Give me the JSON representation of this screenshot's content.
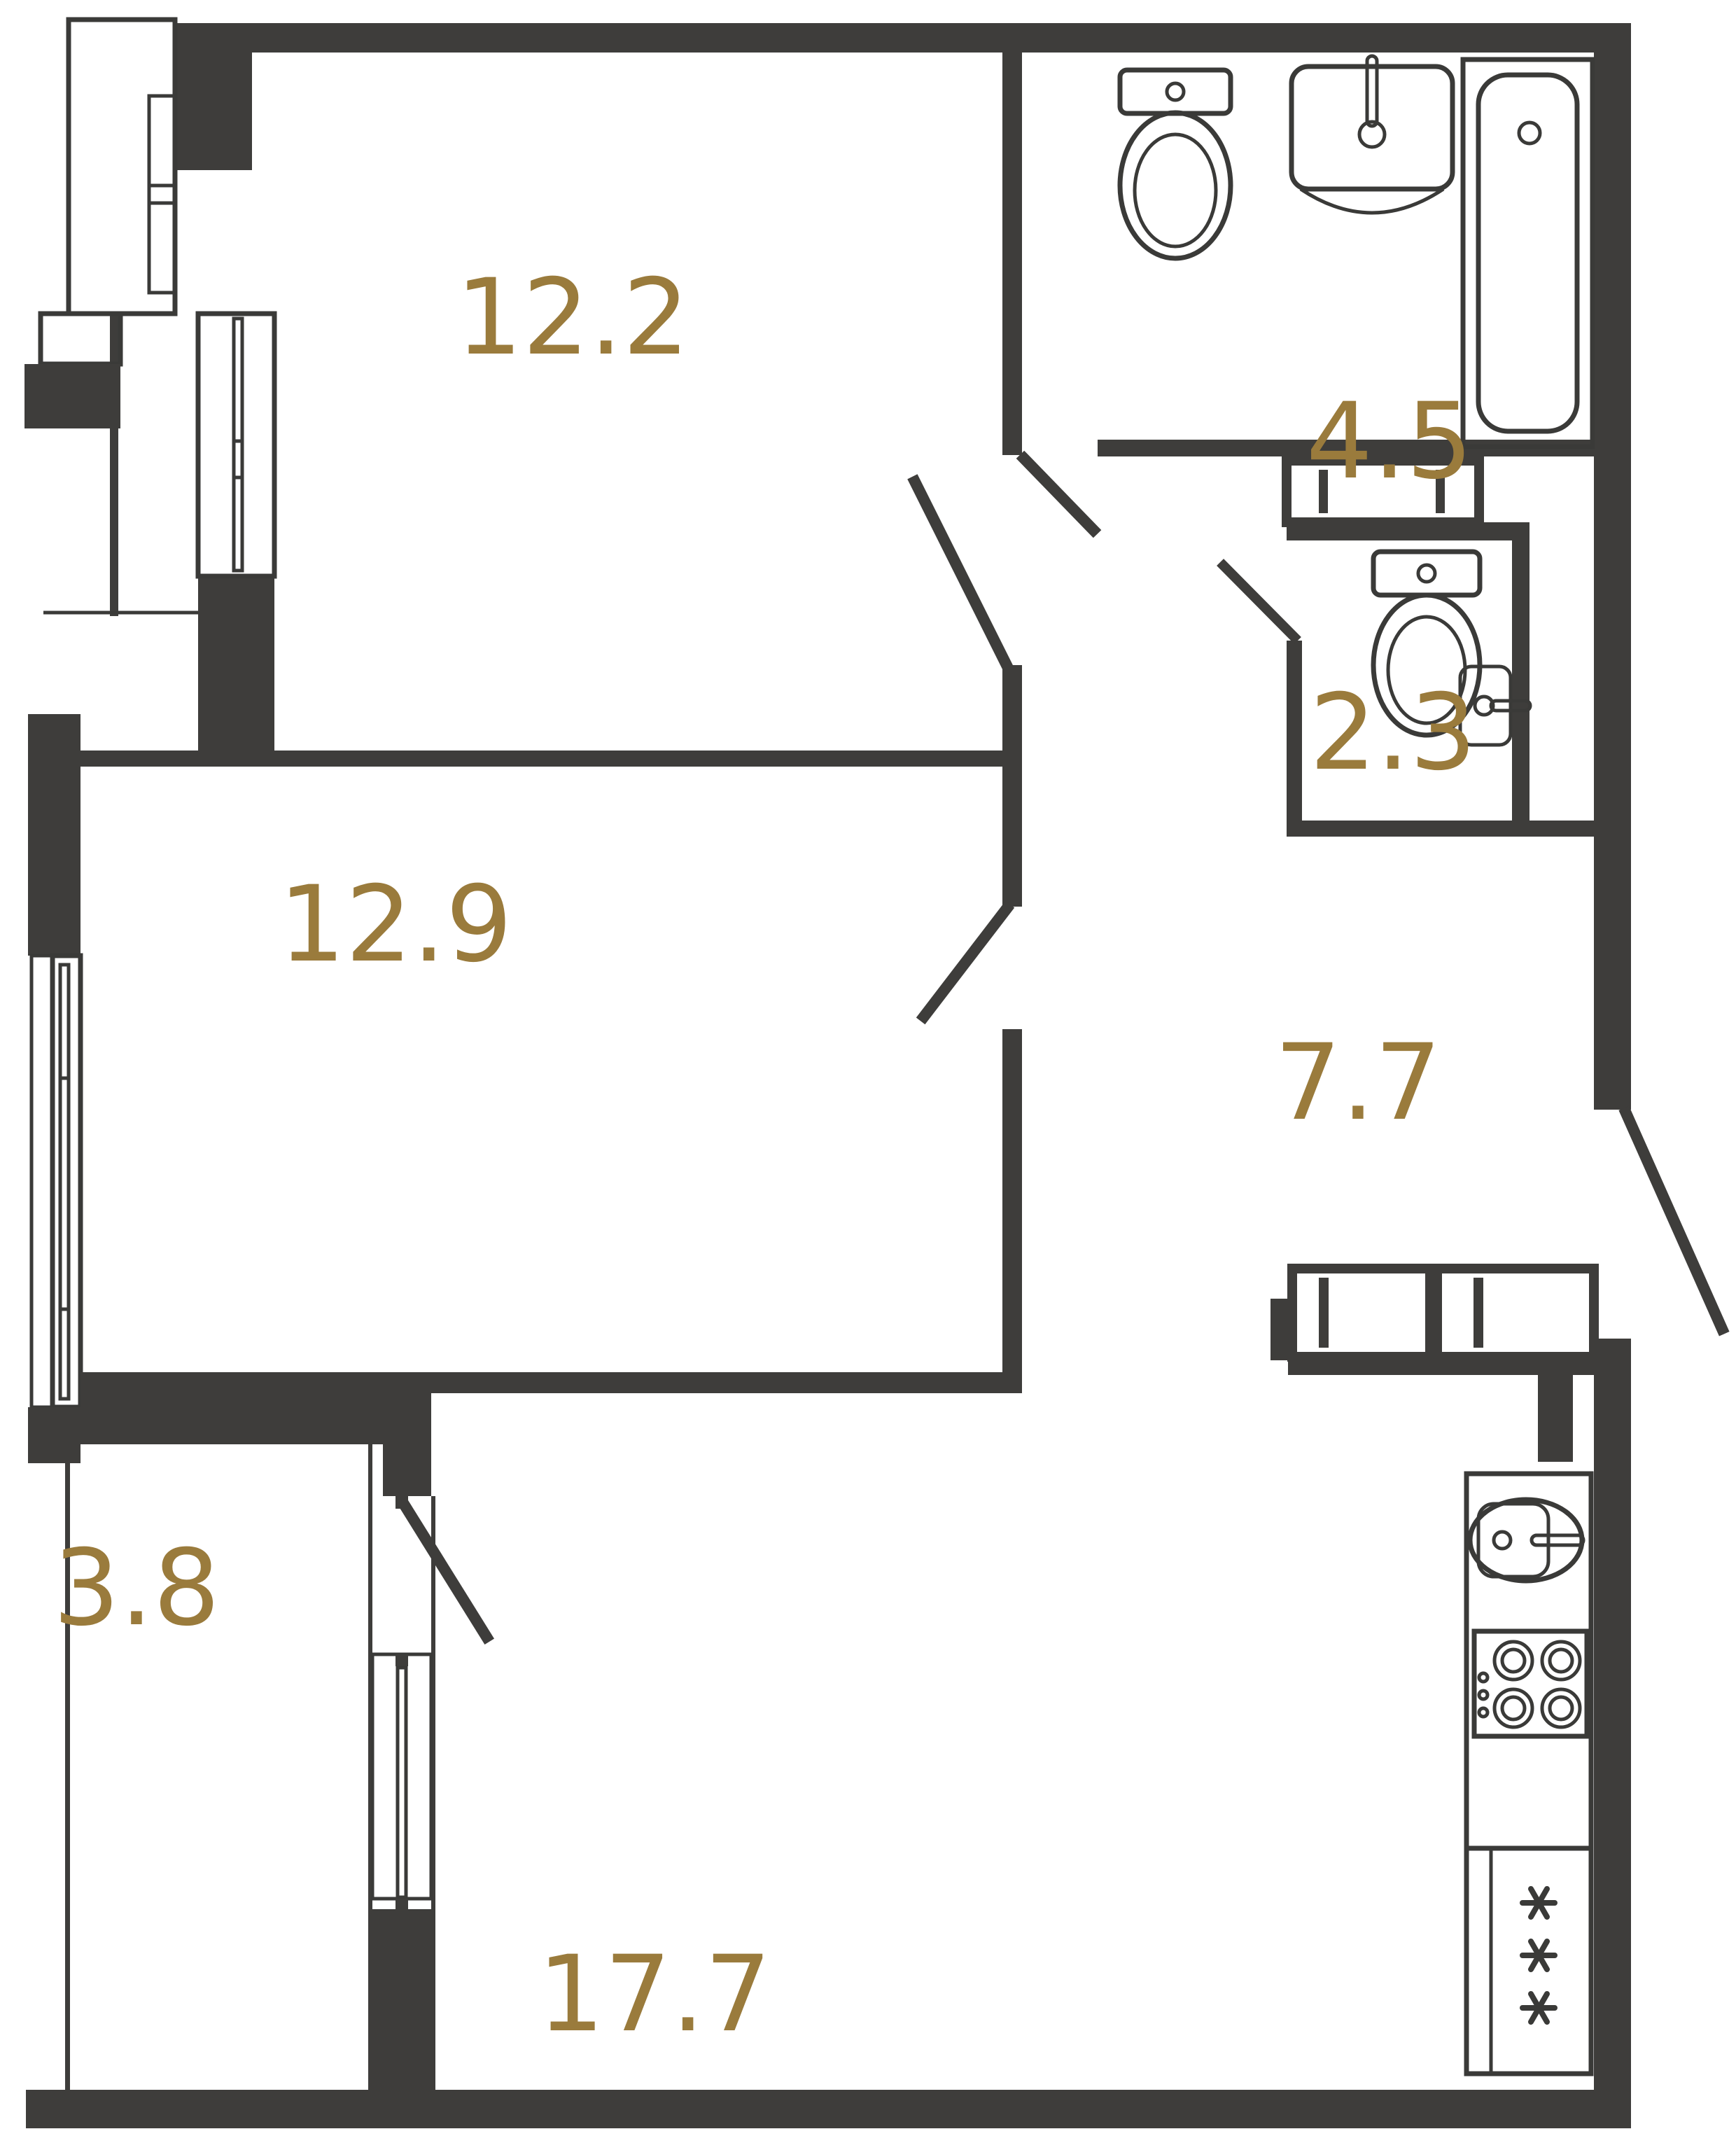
{
  "document_type": "apartment floor plan",
  "colors": {
    "wall": "#3E3D3B",
    "fixture_line": "#3A3A38",
    "label": "#9A7B3C",
    "background": "#FFFFFF"
  },
  "rooms": [
    {
      "id": "room-12-2",
      "area": "12.2"
    },
    {
      "id": "bathroom",
      "area": "4.5"
    },
    {
      "id": "room-12-9",
      "area": "12.9"
    },
    {
      "id": "wc",
      "area": "2.3"
    },
    {
      "id": "hallway",
      "area": "7.7"
    },
    {
      "id": "balcony",
      "area": "3.8"
    },
    {
      "id": "kitchen-living",
      "area": "17.7"
    }
  ],
  "fixtures": {
    "bathroom": [
      "toilet",
      "sink",
      "bathtub"
    ],
    "wc": [
      "toilet",
      "sink"
    ],
    "kitchen": [
      "sink",
      "stove",
      "fridge"
    ],
    "hallway": [
      "wardrobe-niche",
      "wardrobe-left",
      "wardrobe-right"
    ],
    "windows": [
      "room-12-2-window",
      "room-12-9-window",
      "balcony-window"
    ],
    "doors": [
      "entrance-door",
      "room-12-2-door",
      "room-12-9-door",
      "bathroom-door",
      "wc-door",
      "balcony-door"
    ]
  }
}
